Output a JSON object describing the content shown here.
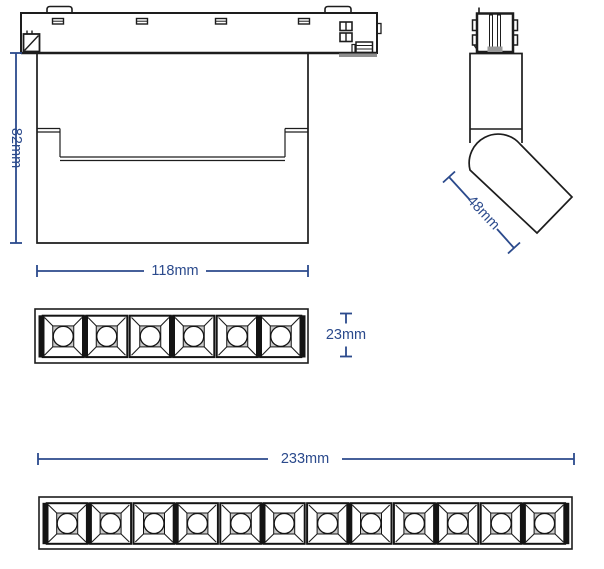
{
  "drawing": {
    "title": "track-spotlight-dimension-drawing",
    "subject": "Adjustable magnetic track linear spotlight",
    "dimensions": {
      "front_height": "82mm",
      "front_width": "118mm",
      "side_head": "48mm",
      "module_small_height": "23mm",
      "module_large_width": "233mm"
    },
    "views": {
      "front": {
        "name": "front-view"
      },
      "side": {
        "name": "side-view-tilted-head"
      },
      "module_small": {
        "name": "led-module-6",
        "cells": 6
      },
      "module_large": {
        "name": "led-module-12",
        "cells": 12
      }
    },
    "colors": {
      "dimension_blue": "#2b4a8c",
      "line_black": "#1d1d1d",
      "gray_fill": "#979797",
      "cell_inner_gray": "#c9c9c9"
    }
  }
}
